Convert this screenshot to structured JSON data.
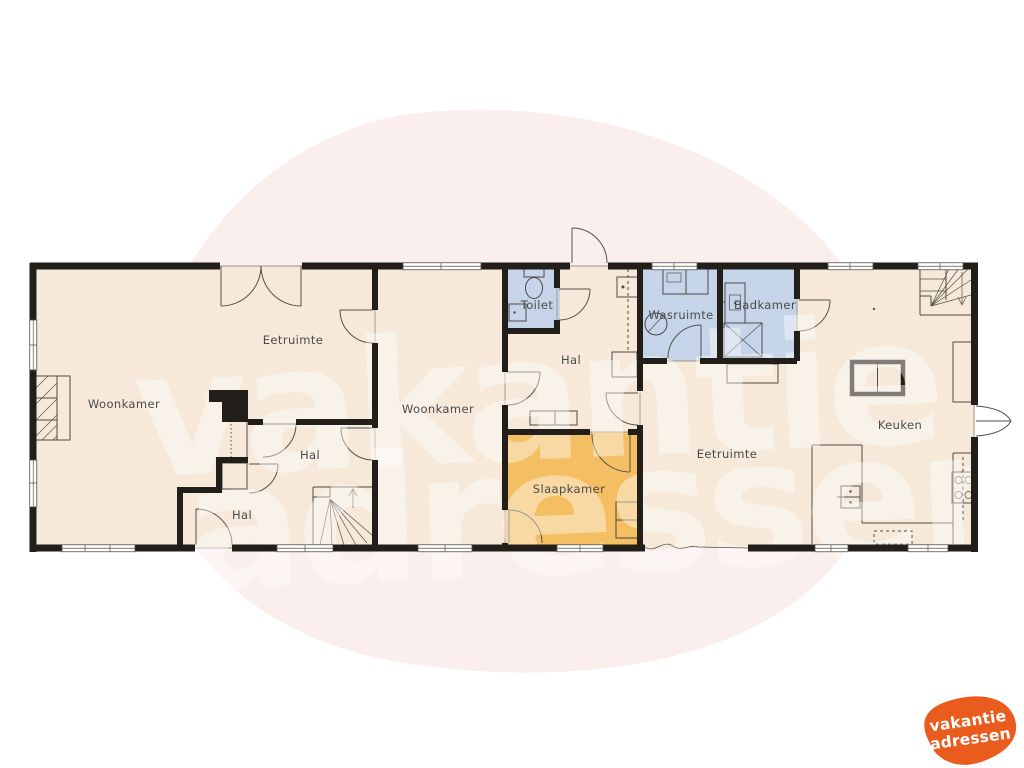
{
  "palette": {
    "background": "#FFFFFF",
    "blob": "#FAEFED",
    "floor": "#F6E9D9",
    "wet_room": "#C5D4E9",
    "bedroom": "#F4BE63",
    "wall": "#221E19",
    "line": "#4E4A45",
    "label_text": "#4A4A4A",
    "watermark_text": "#FFFFFF",
    "logo_orange": "#E95C1E",
    "logo_text": "#FFFFFF"
  },
  "watermark": {
    "line1": "vakantie",
    "line2": "adressen"
  },
  "logo": {
    "line1": "vakantie",
    "line2": "adressen"
  },
  "rooms": [
    {
      "id": "woonkamer-left",
      "label": "Woonkamer"
    },
    {
      "id": "eetruimte-left",
      "label": "Eetruimte"
    },
    {
      "id": "hal-upper-left",
      "label": "Hal"
    },
    {
      "id": "hal-lower-left",
      "label": "Hal"
    },
    {
      "id": "woonkamer-middle",
      "label": "Woonkamer"
    },
    {
      "id": "toilet",
      "label": "Toilet"
    },
    {
      "id": "hal-middle",
      "label": "Hal"
    },
    {
      "id": "slaapkamer",
      "label": "Slaapkamer"
    },
    {
      "id": "wasruimte",
      "label": "Wasruimte"
    },
    {
      "id": "badkamer",
      "label": "Badkamer"
    },
    {
      "id": "eetruimte-right",
      "label": "Eetruimte"
    },
    {
      "id": "keuken",
      "label": "Keuken"
    }
  ]
}
